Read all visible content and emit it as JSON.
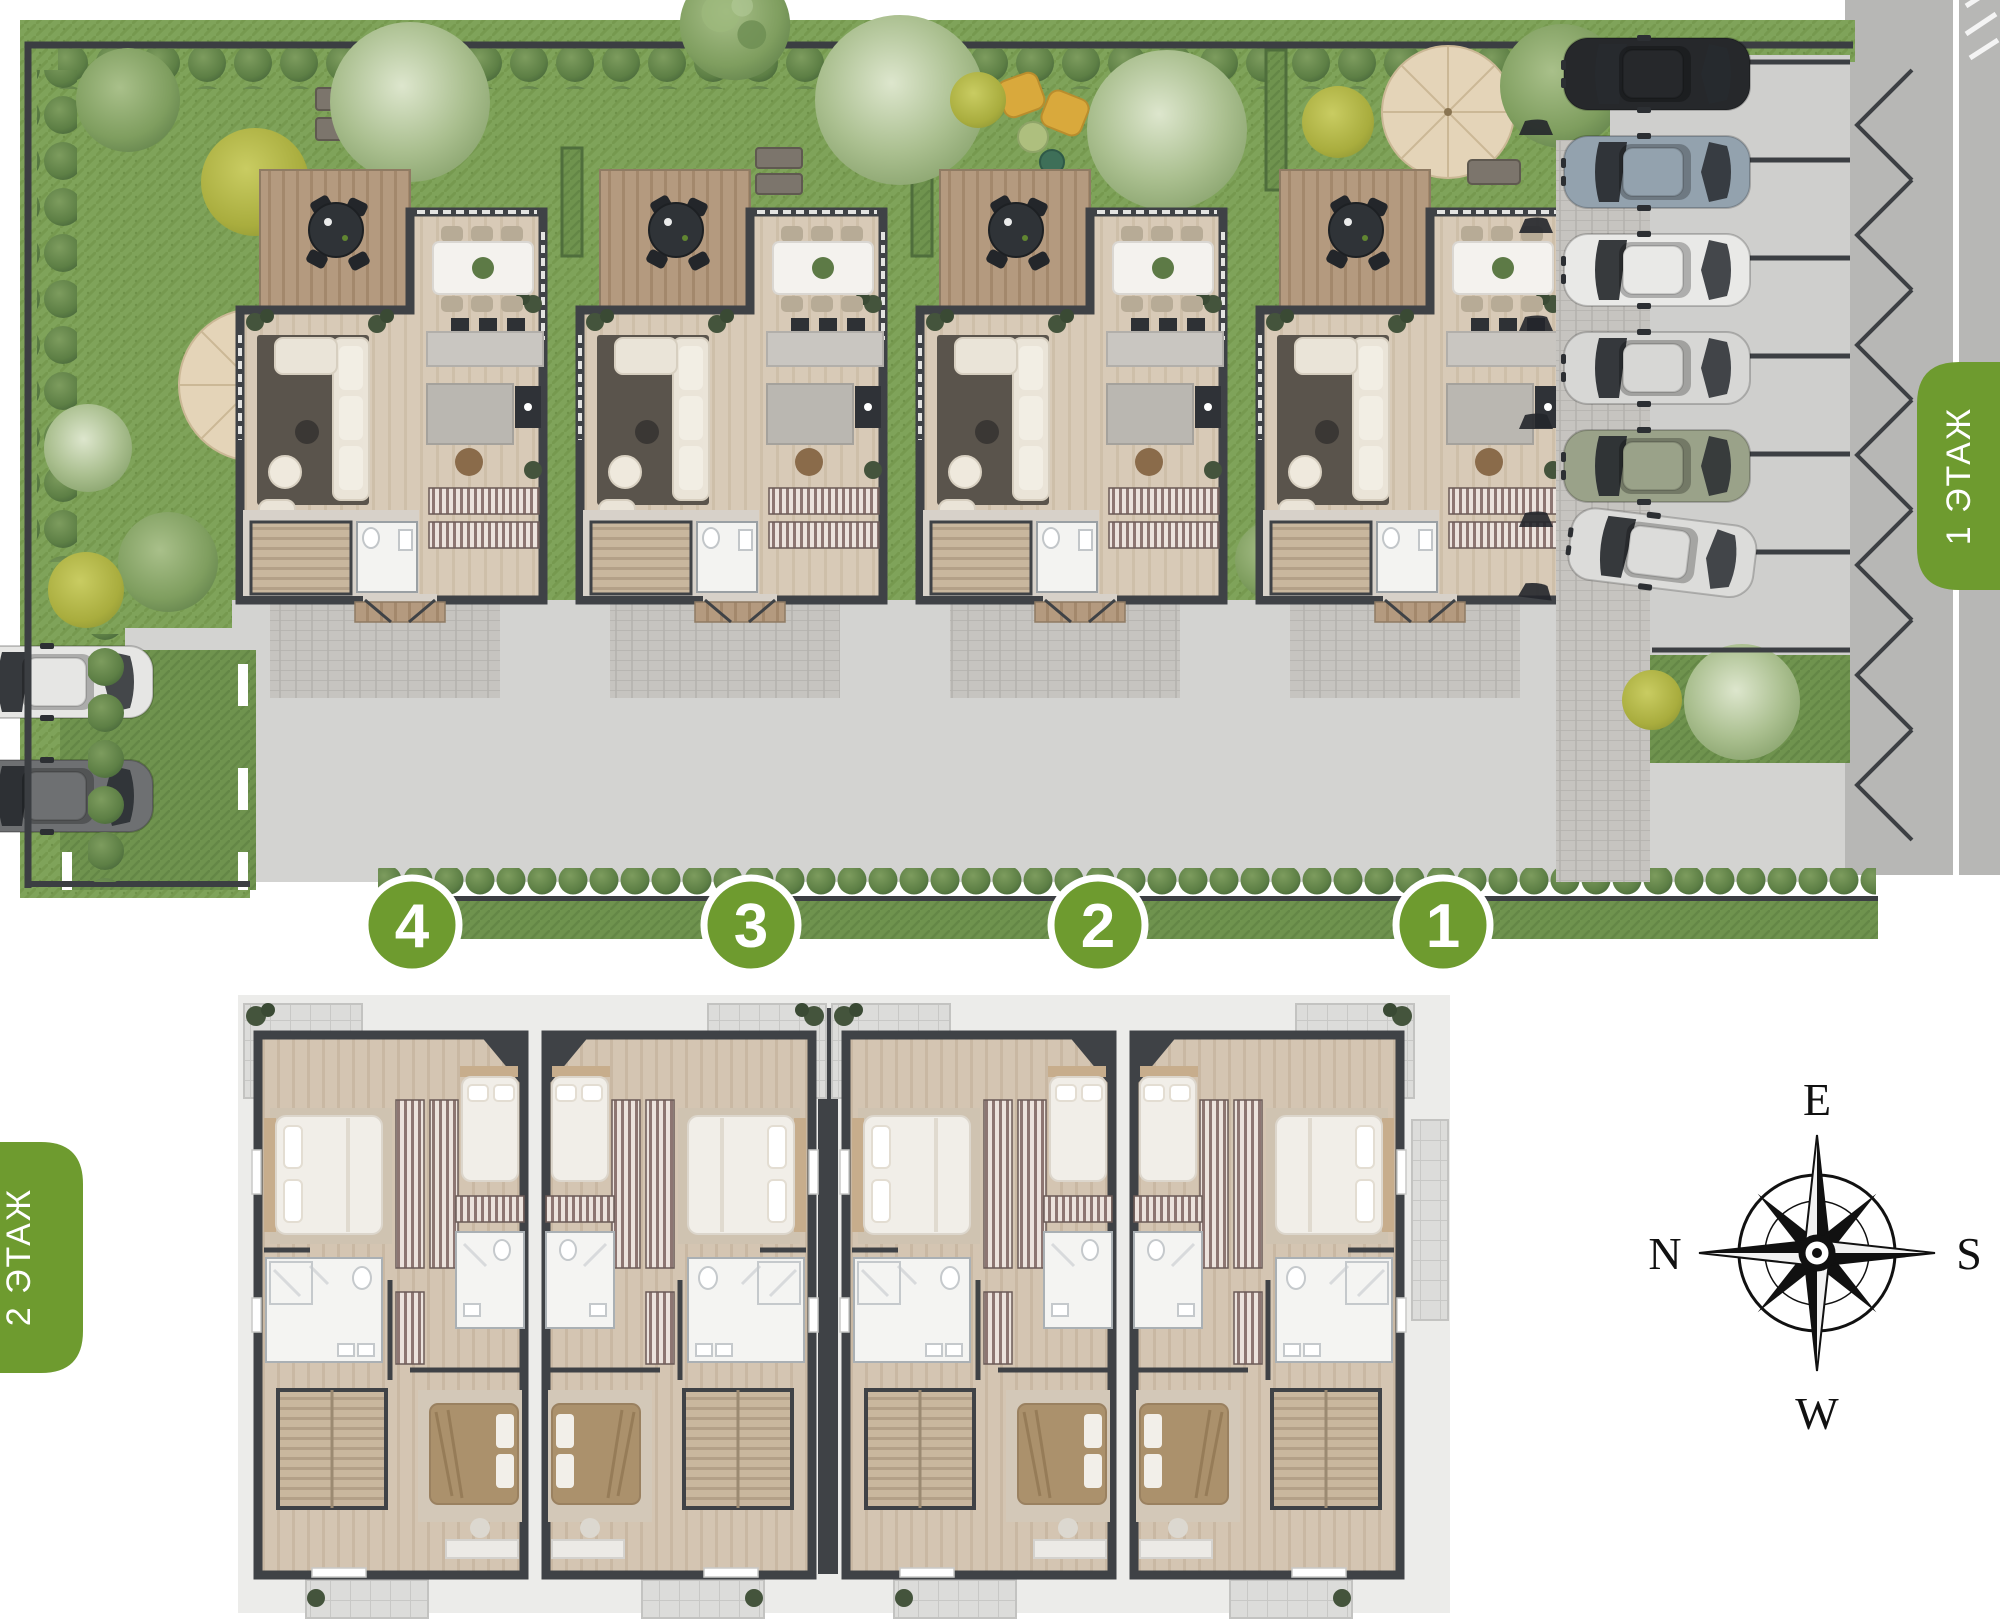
{
  "floors": {
    "first": {
      "label": "1 ЭТАЖ"
    },
    "second": {
      "label": "2 ЭТАЖ"
    }
  },
  "unit_markers": [
    {
      "number": "4"
    },
    {
      "number": "3"
    },
    {
      "number": "2"
    },
    {
      "number": "1"
    }
  ],
  "compass": {
    "top": "E",
    "left": "N",
    "right": "S",
    "bottom": "W"
  },
  "palette": {
    "accent_green": "#6e9b2f",
    "grass": "#7fa35a",
    "hedge": "#5d7f45",
    "wall_dark": "#3f4246",
    "driveway": "#d3d3d1",
    "road": "#b7b7b5",
    "wood_floor": "#d8cab7",
    "deck_wood": "#b49a7f",
    "terrace_tile": "#dcdcda",
    "bathroom_white": "#f4f4f2"
  },
  "parking": {
    "street_row_car_colors": [
      "#26282b",
      "#93a2ae",
      "#e9e9e7",
      "#d7d7d5",
      "#9aa289",
      "#dcdcda"
    ],
    "guest_row_car_colors": [
      "#e6e6e4",
      "#6e7072"
    ]
  }
}
